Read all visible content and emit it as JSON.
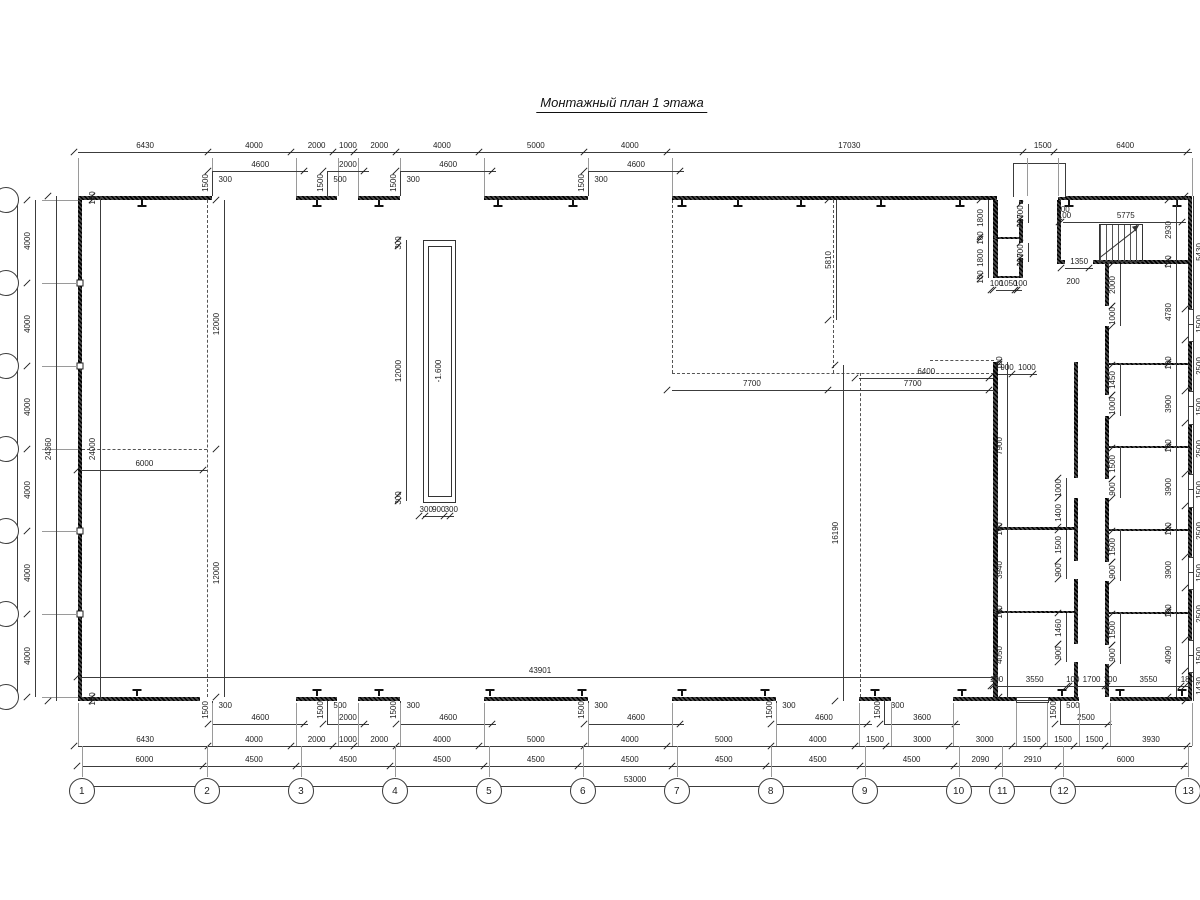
{
  "title": "Монтажный план 1 этажа",
  "pit_label": "-1.600",
  "opening_side_label": "1500",
  "top_marks": [
    "300",
    "500",
    "300",
    "300"
  ],
  "bottom_marks": [
    "300",
    "500",
    "300",
    "300",
    "300",
    "300",
    "500"
  ],
  "grid_bottom": [
    "1",
    "2",
    "3",
    "4",
    "5",
    "6",
    "7",
    "8",
    "9",
    "10",
    "11",
    "12",
    "13"
  ],
  "misc_labels": [
    {
      "t": "200",
      "x": 1073,
      "y": 282,
      "rot": false
    },
    {
      "t": "100",
      "x": 1063,
      "y": 210,
      "rot": false
    }
  ],
  "chains": {
    "top_outer": [
      6430,
      4000,
      2000,
      1000,
      2000,
      4000,
      5000,
      4000,
      17030,
      1500,
      6400
    ],
    "top_openings": [
      {
        "g": 6430
      },
      4600,
      {
        "g": 900
      },
      2000,
      {
        "g": 1500
      },
      4600,
      {
        "g": 4400
      },
      4600
    ],
    "bottom_inner_total": [
      43901
    ],
    "bottom_openings": [
      {
        "g": 6430
      },
      4600,
      {
        "g": 900
      },
      2000,
      {
        "g": 1500
      },
      4600,
      {
        "g": 4400
      },
      4600,
      {
        "g": 4400
      },
      4600,
      {
        "g": 600
      },
      3600,
      {
        "g": 4800
      },
      2500
    ],
    "bottom_outer": [
      6430,
      4000,
      2000,
      1000,
      2000,
      4000,
      5000,
      4000,
      5000,
      4000,
      1500,
      3000,
      3000,
      1500,
      1500,
      1500,
      3930
    ],
    "bottom_axes": [
      6000,
      4500,
      4500,
      4500,
      4500,
      4500,
      4500,
      4500,
      4500,
      2090,
      2910,
      6000
    ],
    "bottom_total": [
      53000
    ],
    "left_total": [
      24000
    ],
    "left_axes": [
      4000,
      4000,
      4000,
      4000,
      4000,
      4000
    ],
    "left_overall": [
      24360
    ],
    "left_inner": [
      180,
      24000,
      180
    ],
    "grid2_vert": [
      12000,
      12000
    ],
    "mid_6000": [
      6000
    ],
    "mezz_bottom": [
      7700,
      7700
    ],
    "mezz_5810": [
      5810
    ],
    "hall_6400": [
      6400
    ],
    "hall_16190": [
      16190
    ],
    "pit_v": [
      300,
      12000,
      300
    ],
    "pit_h": [
      300,
      900,
      300
    ],
    "colA_left": [
      100,
      7900,
      100,
      3940,
      100,
      4050
    ],
    "colA_right": [
      1000,
      1400,
      {
        "g": 100
      },
      1500,
      900,
      {
        "g": 1640
      },
      1460,
      900
    ],
    "colB_left": [
      2000,
      1000,
      {
        "g": 1880
      },
      1450,
      1000,
      {
        "g": 1550
      },
      1500,
      900,
      {
        "g": 1600
      },
      1500,
      900,
      {
        "g": 1600
      },
      1500,
      900
    ],
    "colB_right": [
      2930,
      100,
      4780,
      100,
      3900,
      100,
      3900,
      100,
      3900,
      100,
      4090
    ],
    "right_windows": [
      5430,
      1500,
      2500,
      1500,
      2500,
      1500,
      2500,
      1500,
      2500,
      1500,
      1430
    ],
    "block_bottom": [
      100,
      3550,
      100,
      1700,
      100,
      3550,
      180
    ],
    "stair_top": [
      100,
      5775
    ],
    "stair_door": [
      1350
    ],
    "m1_top": [
      900,
      1000
    ],
    "smallrooms_left": [
      1800,
      100,
      1800,
      100
    ],
    "smallrooms_bottom": [
      100,
      1050,
      100
    ],
    "door1_marks": [
      700,
      200
    ],
    "door2_marks": [
      700,
      200
    ]
  }
}
